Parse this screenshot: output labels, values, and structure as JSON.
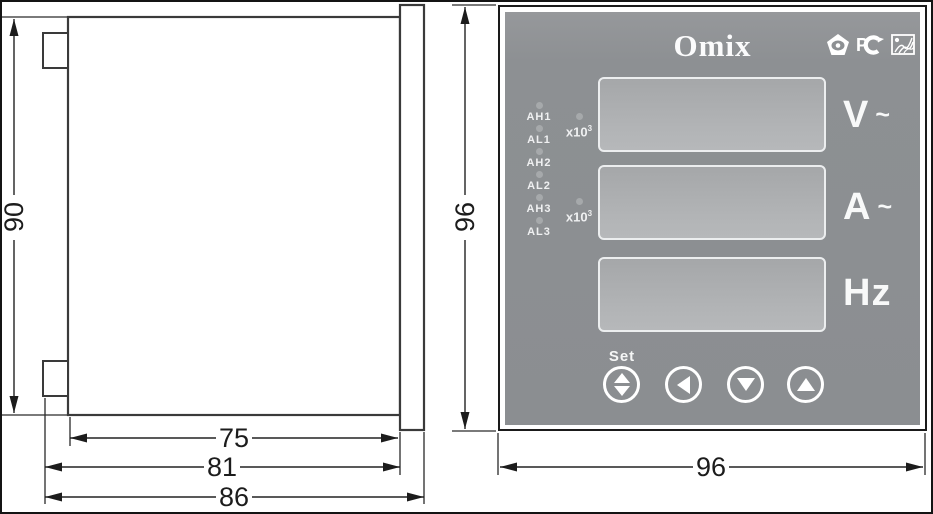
{
  "diagram": {
    "side_view": {
      "dim_height": "90",
      "dim_body_depth": "75",
      "dim_depth_with_clips": "81",
      "dim_total_depth": "86"
    },
    "front_view": {
      "dim_height": "96",
      "dim_width": "96"
    }
  },
  "panel": {
    "brand": "Omix",
    "leds": [
      {
        "label": "AH1"
      },
      {
        "label": "AL1"
      },
      {
        "label": "AH2"
      },
      {
        "label": "AL2"
      },
      {
        "label": "AH3"
      },
      {
        "label": "AL3"
      }
    ],
    "multipliers": [
      {
        "base": "x10",
        "exp": "3"
      },
      {
        "base": "x10",
        "exp": "3"
      }
    ],
    "channels": [
      {
        "unit": "V",
        "wave": "~"
      },
      {
        "unit": "A",
        "wave": "~"
      },
      {
        "unit": "Hz",
        "wave": ""
      }
    ],
    "buttons": {
      "set_label": "Set"
    },
    "colors": {
      "panel_face": "#8d9093",
      "display_window": "#aeb0b2",
      "label_text": "#ffffff",
      "drawing_line": "#2a2a2a"
    }
  }
}
